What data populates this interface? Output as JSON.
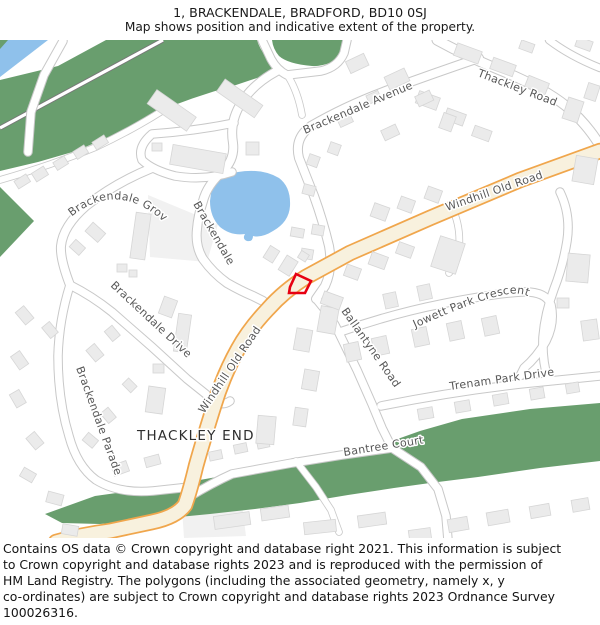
{
  "header": {
    "title": "1, BRACKENDALE, BRADFORD, BD10 0SJ",
    "subtitle": "Map shows position and indicative extent of the property."
  },
  "map": {
    "place_labels": {
      "thackley_end": "THACKLEY END"
    },
    "street_labels": {
      "thackley_road": "Thackley Road",
      "windhill_old_road_upper": "Windhill Old Road",
      "windhill_old_road_lower": "Windhill Old Road",
      "brackendale_avenue": "Brackendale Avenue",
      "brackendale_grove": "Brackendale Grove",
      "brackendale": "Brackendale",
      "brackendale_drive": "Brackendale Drive",
      "brackendale_parade": "Brackendale Parade",
      "ballantyne_road": "Ballantyne Road",
      "jowett_park_crescent": "Jowett Park Crescent",
      "trenam_park_drive": "Trenam Park Drive",
      "bantree_court": "Bantree Court"
    }
  },
  "colors": {
    "property-red": "#e70012",
    "road-primary-fill": "#f8f1de",
    "road-primary-casing": "#f0a64c",
    "road-casing": "#c8c8c8",
    "greenspace": "#699e6e",
    "water": "#8fc1eb",
    "building-fill": "#ebebeb",
    "building-stroke": "#d6d6d6",
    "label-gray": "#575757"
  },
  "footer": {
    "lines": [
      "Contains OS data © Crown copyright and database right 2021. This information is subject",
      "to Crown copyright and database rights 2023 and is reproduced with the permission of",
      "HM Land Registry. The polygons (including the associated geometry, namely x, y",
      "co-ordinates) are subject to Crown copyright and database rights 2023 Ordnance Survey",
      "100026316."
    ]
  }
}
